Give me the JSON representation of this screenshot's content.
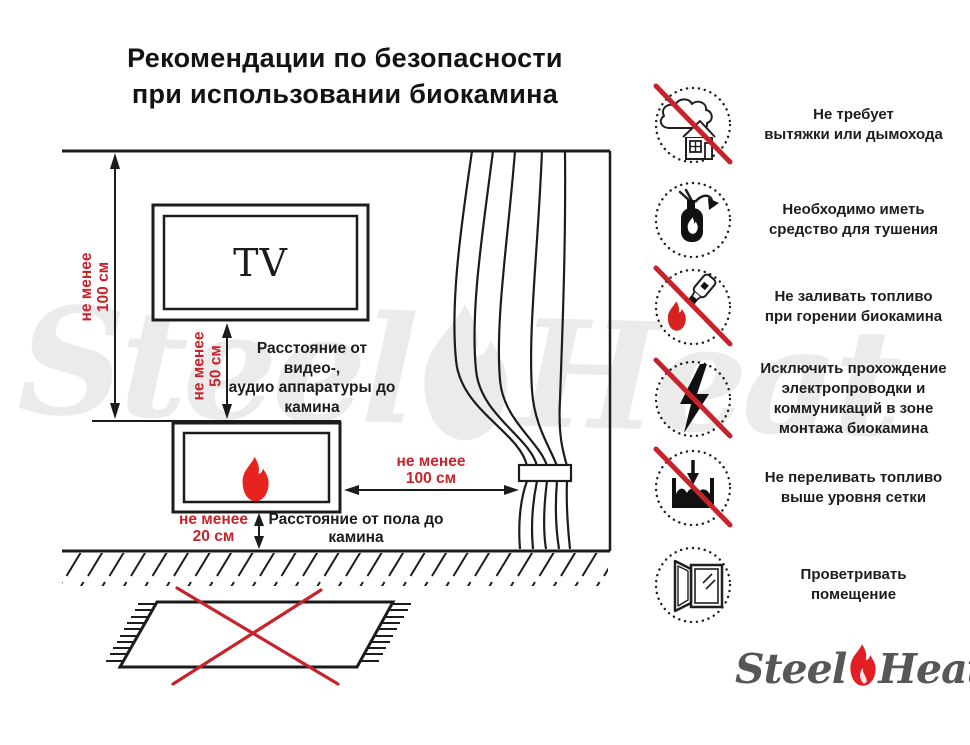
{
  "title": {
    "line1": "Рекомендации по безопасности",
    "line2": "при использовании биокамина"
  },
  "diagram": {
    "tv_label": "TV",
    "dim_wall": {
      "line1": "не менее",
      "line2": "100 см"
    },
    "dim_tv": {
      "line1": "не менее",
      "line2": "50 см"
    },
    "dim_curtain": {
      "line1": "не менее",
      "line2": "100 см"
    },
    "dim_floor": {
      "line1": "не менее",
      "line2": "20 см"
    },
    "label_av": {
      "line1": "Расстояние от видео-,",
      "line2": "аудио аппаратуры до",
      "line3": "камина"
    },
    "label_floor": {
      "line1": "Расстояние от пола до",
      "line2": "камина"
    }
  },
  "rules": [
    {
      "icon": "no-chimney-icon",
      "crossed": true,
      "lines": [
        "Не требует",
        "вытяжки или дымохода"
      ]
    },
    {
      "icon": "extinguisher-icon",
      "crossed": false,
      "lines": [
        "Необходимо иметь",
        "средство для тушения"
      ]
    },
    {
      "icon": "no-refuel-burning-icon",
      "crossed": true,
      "lines": [
        "Не заливать топливо",
        "при горении биокамина"
      ]
    },
    {
      "icon": "no-wiring-icon",
      "crossed": true,
      "lines": [
        "Исключить прохождение",
        "электропроводки и",
        "коммуникаций в зоне",
        "монтажа биокамина"
      ]
    },
    {
      "icon": "no-overfill-icon",
      "crossed": true,
      "lines": [
        "Не переливать топливо",
        "выше уровня сетки"
      ]
    },
    {
      "icon": "ventilate-icon",
      "crossed": false,
      "lines": [
        "Проветривать",
        "помещение"
      ]
    }
  ],
  "logo": {
    "part1": "Steel",
    "part2": "Heat"
  },
  "watermark": {
    "part1": "Steel",
    "part2": "Heat"
  },
  "colors": {
    "accent_red": "#c8232b",
    "flame_red": "#e8231f",
    "line_black": "#1c1c1c",
    "logo_gray": "#57575a"
  }
}
